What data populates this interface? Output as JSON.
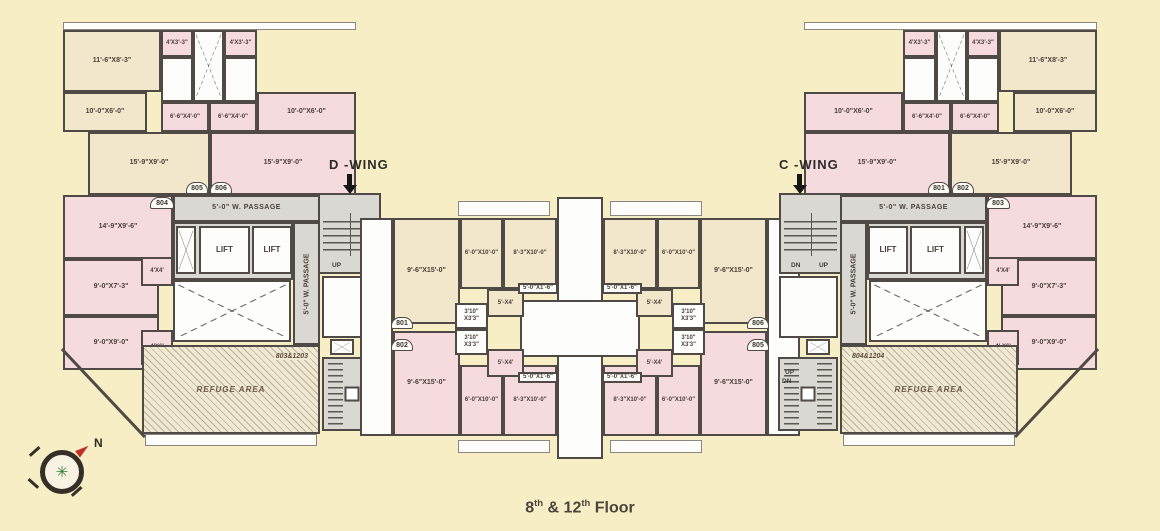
{
  "caption": {
    "p1": "8",
    "sup1": "th",
    "p2": " & 12",
    "sup2": "th",
    "p3": " Floor"
  },
  "wings": {
    "left": "D -WING",
    "right": "C -WING"
  },
  "compass": {
    "north": "N"
  },
  "passage": "5'-0\" W. PASSAGE",
  "lift": "LIFT",
  "stairs": {
    "up": "UP",
    "dn": "DN"
  },
  "refuge": {
    "label": "REFUGE AREA",
    "left_flats": "803&1203",
    "right_flats": "804&1204"
  },
  "flat_numbers": {
    "n801": "801",
    "n802": "802",
    "n803": "803",
    "n804": "804",
    "n805": "805",
    "n806": "806"
  },
  "dims": {
    "d11_6x8_3": "11'-6\"X8'-3\"",
    "d4x3_3": "4'X3'-3\"",
    "d10x6": "10'-0\"X6'-0\"",
    "d6_6x4": "6'-6\"X4'-0\"",
    "d15_9x9": "15'-9\"X9'-0\"",
    "d14_9x9_6": "14'-9\"X9'-6\"",
    "d9x7_3": "9'-0\"X7'-3\"",
    "d4x4": "4'X4'",
    "d9x9": "9'-0\"X9'-0\"",
    "d4x6": "4'X6'",
    "d4x6_r": "4'-X6'",
    "d9_6x15": "9'-6\"X15'-0\"",
    "d6x10": "6'-0\"X10'-0\"",
    "d8_3x10": "8'-3\"X10'-0\"",
    "d5x4": "5'-X4'",
    "d3_10a": "3'10\"",
    "d3_10b": "X3'3\"",
    "d5x1_6": "5'-0\"X1'-6\""
  },
  "colors": {
    "background": "#f8eec5",
    "room_pink": "#f5dade",
    "room_tan": "#f2e7cb",
    "passage_gray": "#dad8d2",
    "wall": "#4f4a45",
    "north_red": "#c03028",
    "compass_green": "#2f7d32"
  }
}
